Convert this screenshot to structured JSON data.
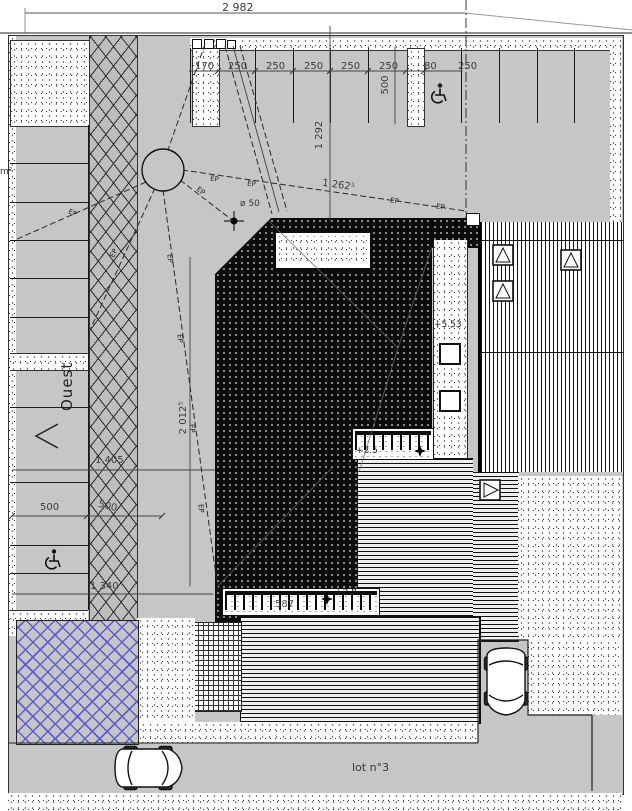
{
  "plan": {
    "labels": {
      "west": "Ouest",
      "lot": "lot n°3",
      "area_unit": "m²",
      "ep": "EP",
      "pipe_dia": "ø 50"
    },
    "levels": {
      "roof": "+5.53",
      "terrace_upper": "+2.5",
      "terrace_lower": "+2.8"
    },
    "dims": {
      "total_width": "2 982",
      "row": [
        "170",
        "250",
        "250",
        "250",
        "250",
        "250",
        "80",
        "250"
      ],
      "depth_500": "500",
      "v_1292": "1 292",
      "diag_1262": "1 262⁵",
      "v_2012": "2 012⁵",
      "h_1405": "1 405",
      "pair_500": [
        "500",
        "500"
      ],
      "h_1340": "1 340",
      "pergola": "587"
    },
    "colors": {
      "field_gray": "#c6c6c6",
      "roof_black": "#0c0c0c",
      "blue_hatch": "#5c5cd6",
      "line": "#1a1a1a"
    }
  }
}
